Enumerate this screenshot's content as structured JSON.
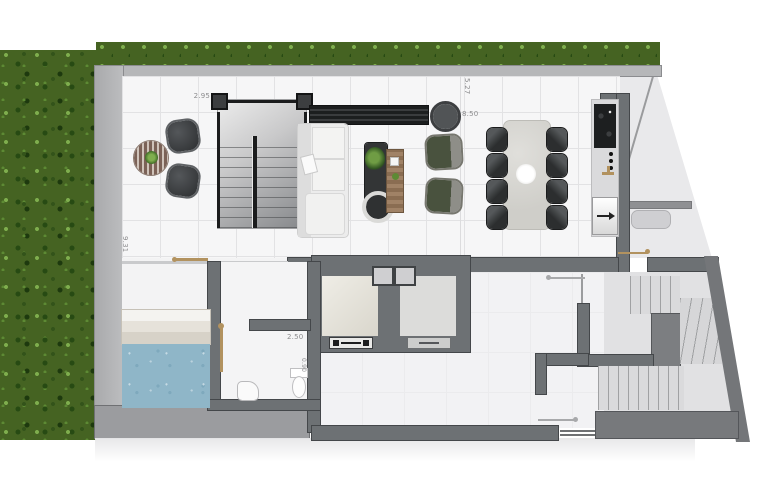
{
  "dimensions": {
    "stair_bay": "2.95",
    "upper_terrace_depth": "5.27",
    "living_span": "8.50",
    "left_wing_depth": "9.31",
    "service_hall": "2.50",
    "wc_nook": "0.90"
  },
  "palette": {
    "grass": "#456322",
    "pool_water": "#8fb6c8",
    "wall_dark": "#6d7174",
    "wall_light": "#b6b7b9",
    "floor_tile": "#f6f6f7",
    "door_symbol": "#b2925f",
    "armchair_green": "#49523e"
  }
}
